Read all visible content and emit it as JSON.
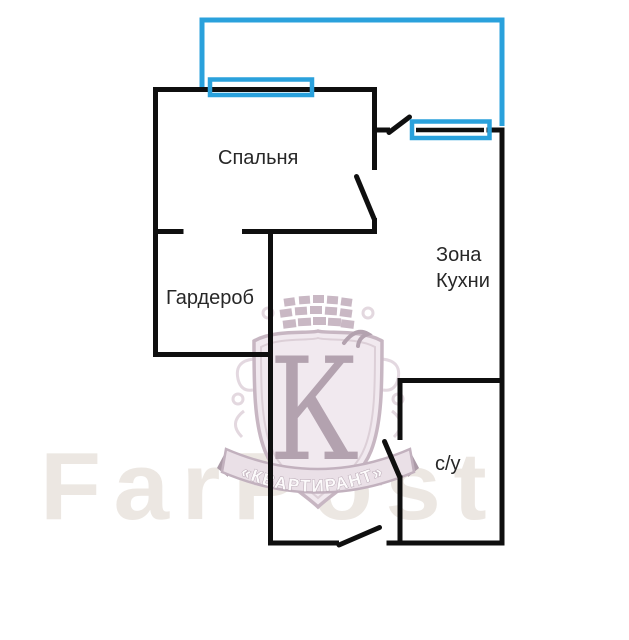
{
  "plan": {
    "type": "apartment-floorplan",
    "rooms": [
      {
        "name": "bedroom",
        "label": "Спальня"
      },
      {
        "name": "wardrobe",
        "label": "Гардероб"
      },
      {
        "name": "kitchen-zone",
        "label": "Зона Кухни",
        "label_lines": [
          "Зона",
          "Кухни"
        ]
      },
      {
        "name": "bathroom",
        "label": "с/у"
      }
    ],
    "features": [
      "balcony-outline",
      "bedroom-window",
      "kitchen-window",
      "bedroom-door",
      "balcony-door",
      "bathroom-door",
      "entry-door"
    ]
  },
  "watermark": {
    "crest_letter": "К",
    "crest_banner": "«КВАРТИРАНТ»",
    "site_text": "FarPost"
  },
  "colors": {
    "wall": "#0f0f0f",
    "balcony_blue": "#2aa1dc",
    "label_text": "#272727",
    "crest_main": "#b3a2af",
    "crest_fill": "#f1e9ef",
    "site_mark": "#ece7e2"
  }
}
